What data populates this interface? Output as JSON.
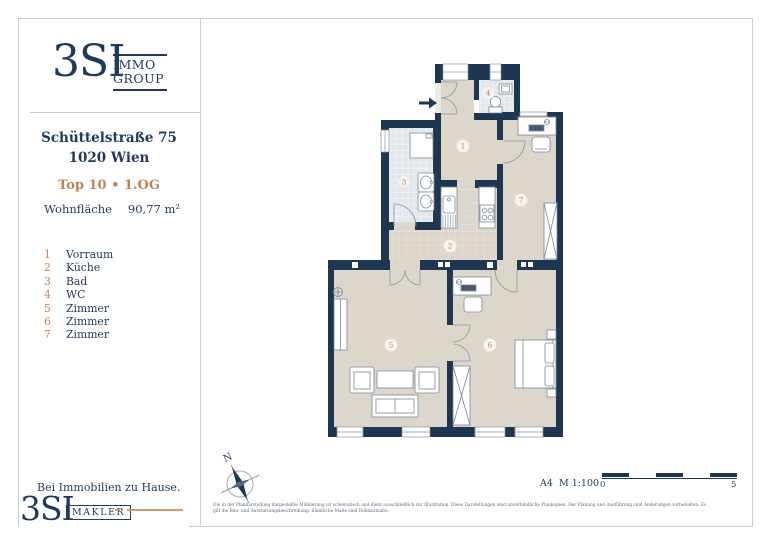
{
  "brand": {
    "logo_text": "3SI",
    "logo_sub1": "IMMO",
    "logo_sub2": "GROUP",
    "footer_tagline": "Bei Immobilien zu Hause.",
    "footer_logo_text": "3SI",
    "footer_logo_sub": "MAKLER"
  },
  "property": {
    "address_line1": "Schüttelstraße 75",
    "address_line2": "1020 Wien",
    "unit": "Top 10 • 1.OG",
    "area_label": "Wohnfläche",
    "area_value": "90,77 m²"
  },
  "legend": {
    "items": [
      {
        "num": "1",
        "label": "Vorraum"
      },
      {
        "num": "2",
        "label": "Küche"
      },
      {
        "num": "3",
        "label": "Bad"
      },
      {
        "num": "4",
        "label": "WC"
      },
      {
        "num": "5",
        "label": "Zimmer"
      },
      {
        "num": "6",
        "label": "Zimmer"
      },
      {
        "num": "7",
        "label": "Zimmer"
      }
    ]
  },
  "plan": {
    "rooms": [
      "1",
      "2",
      "3",
      "4",
      "5",
      "6",
      "7"
    ],
    "north_label": "N"
  },
  "footer": {
    "disclaimer_line1": "Die in der Plandarstellung dargestellte Möblierung ist schematisch und dient ausschließlich zur Illustration. Diese Darstellungen sind unverbindliche Plankopien. Der Planung und Ausführung sind Änderungen vorbehalten. Es",
    "disclaimer_line2": "gilt die Bau- und Ausstattungsbeschreibung. Sämtliche Maße sind Rohbaumaße.",
    "format_scale": "A4  M 1:100",
    "scale_start": "0",
    "scale_end": "5"
  },
  "colors": {
    "navy": "#1e3a5f",
    "wall": "#1d3651",
    "bronze": "#bd8355",
    "floor_beige": "#ddd6cb",
    "tile_blue": "#e3e8ec",
    "frame_grey": "#c9cdd3"
  }
}
